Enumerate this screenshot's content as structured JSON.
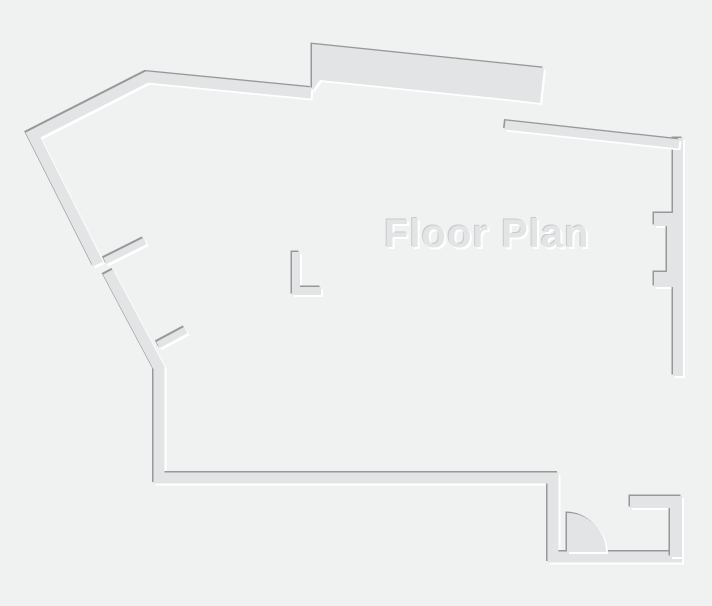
{
  "title": "Floor Plan",
  "canvas": {
    "width": 712,
    "height": 606
  },
  "colors": {
    "background": "#f0f1f1",
    "wall": "#e2e4e5",
    "shadow_dark": "#96989a",
    "highlight": "#ffffff",
    "text": "#e3e4e5",
    "text_shadow_dark": "#c8cacb"
  },
  "floorplan": {
    "polygons": [
      {
        "name": "top-band-wall",
        "points": [
          [
            312,
            44
          ],
          [
            544,
            68
          ],
          [
            540,
            103
          ],
          [
            506,
            99
          ],
          [
            320,
            80
          ],
          [
            312,
            91
          ]
        ]
      },
      {
        "name": "right-wall-with-pilasters",
        "points": [
          [
            673,
            138
          ],
          [
            683,
            138
          ],
          [
            683,
            376
          ],
          [
            673,
            376
          ],
          [
            673,
            287
          ],
          [
            654,
            287
          ],
          [
            654,
            272
          ],
          [
            667,
            272
          ],
          [
            667,
            226
          ],
          [
            654,
            226
          ],
          [
            654,
            213
          ],
          [
            673,
            213
          ]
        ]
      }
    ],
    "strokes": [
      {
        "name": "outer-wall-top-left",
        "points": [
          [
            98,
            264
          ],
          [
            33,
            135
          ],
          [
            147,
            77
          ],
          [
            311,
            93
          ]
        ],
        "width": 11
      },
      {
        "name": "outer-wall-left-bottom",
        "points": [
          [
            108,
            272
          ],
          [
            159,
            368
          ],
          [
            159,
            478
          ],
          [
            553,
            478
          ],
          [
            553,
            557
          ],
          [
            682,
            557
          ]
        ],
        "width": 11
      },
      {
        "name": "top-jog-wall",
        "points": [
          [
            506,
            97
          ],
          [
            506,
            124
          ]
        ],
        "width": 7
      },
      {
        "name": "outer-wall-top-right",
        "points": [
          [
            505,
            125
          ],
          [
            679,
            144
          ]
        ],
        "width": 9
      },
      {
        "name": "step-wall-horizontal",
        "points": [
          [
            683,
            371
          ],
          [
            617,
            371
          ]
        ],
        "width": 11
      },
      {
        "name": "step-wall-vertical",
        "points": [
          [
            622,
            366
          ],
          [
            622,
            508
          ]
        ],
        "width": 13
      },
      {
        "name": "entry-right-wall",
        "points": [
          [
            630,
            502
          ],
          [
            676,
            502
          ],
          [
            676,
            557
          ]
        ],
        "width": 12
      },
      {
        "name": "interior-wall-a",
        "points": [
          [
            219,
            95
          ],
          [
            219,
            278
          ]
        ],
        "width": 8
      },
      {
        "name": "interior-wall-b",
        "points": [
          [
            241,
            95
          ],
          [
            241,
            244
          ]
        ],
        "width": 8
      },
      {
        "name": "interior-wall-c",
        "points": [
          [
            237,
            244
          ],
          [
            317,
            244
          ]
        ],
        "width": 8
      },
      {
        "name": "interior-stub-d",
        "points": [
          [
            314,
            212
          ],
          [
            314,
            240
          ]
        ],
        "width": 8
      },
      {
        "name": "interior-stub-e",
        "points": [
          [
            252,
            250
          ],
          [
            252,
            302
          ]
        ],
        "width": 8
      },
      {
        "name": "interior-wall-f",
        "points": [
          [
            296,
            252
          ],
          [
            296,
            291
          ],
          [
            321,
            291
          ]
        ],
        "width": 8
      },
      {
        "name": "north-wall-stub",
        "points": [
          [
            193,
            341
          ],
          [
            213,
            341
          ]
        ],
        "width": 9
      },
      {
        "name": "north-wall-seg1",
        "points": [
          [
            255,
            341
          ],
          [
            373,
            341
          ]
        ],
        "width": 9
      },
      {
        "name": "north-wall-hook",
        "points": [
          [
            250,
            331
          ],
          [
            250,
            341
          ]
        ],
        "width": 6
      },
      {
        "name": "north-wall-seg2",
        "points": [
          [
            400,
            341
          ],
          [
            467,
            341
          ]
        ],
        "width": 9
      },
      {
        "name": "room-divider-1",
        "points": [
          [
            177,
            345
          ],
          [
            177,
            472
          ]
        ],
        "width": 9
      },
      {
        "name": "room-divider-2",
        "points": [
          [
            293,
            347
          ],
          [
            293,
            472
          ]
        ],
        "width": 8
      },
      {
        "name": "room-divider-3",
        "points": [
          [
            361,
            346
          ],
          [
            361,
            472
          ]
        ],
        "width": 8
      },
      {
        "name": "room-divider-4",
        "points": [
          [
            443,
            348
          ],
          [
            443,
            465
          ]
        ],
        "width": 8
      },
      {
        "name": "room-end-stub",
        "points": [
          [
            556,
            440
          ],
          [
            556,
            472
          ]
        ],
        "width": 8
      },
      {
        "name": "room-bottom-1",
        "points": [
          [
            173,
            468
          ],
          [
            289,
            468
          ]
        ],
        "width": 8
      },
      {
        "name": "room-bottom-2",
        "points": [
          [
            297,
            468
          ],
          [
            358,
            468
          ]
        ],
        "width": 8
      },
      {
        "name": "room-bottom-3",
        "points": [
          [
            366,
            468
          ],
          [
            440,
            468
          ]
        ],
        "width": 8
      },
      {
        "name": "room-bottom-4",
        "points": [
          [
            452,
            468
          ],
          [
            554,
            468
          ]
        ],
        "width": 8
      },
      {
        "name": "door-leaf-1",
        "points": [
          [
            105,
            261
          ],
          [
            145,
            241
          ]
        ],
        "width": 7
      },
      {
        "name": "door-leaf-2",
        "points": [
          [
            158,
            345
          ],
          [
            186,
            330
          ]
        ],
        "width": 7
      }
    ],
    "arcs": [
      {
        "name": "entry-door-swing",
        "d": "M 567 552 L 567 513 A 39 39 0 0 1 606 552 Z"
      }
    ]
  }
}
